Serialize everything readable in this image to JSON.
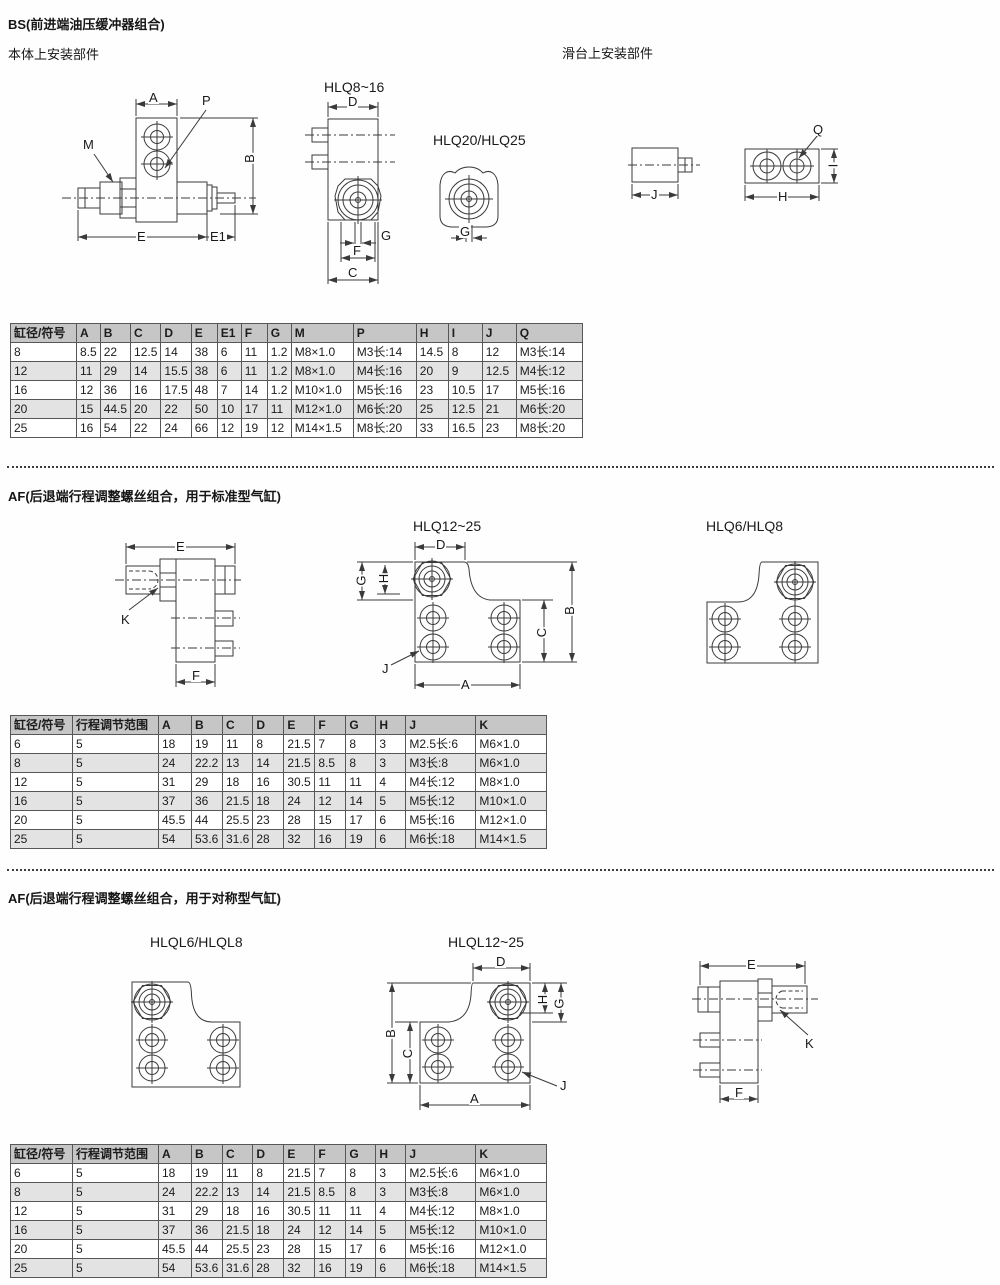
{
  "bs": {
    "title": "BS(前进端油压缓冲器组合)",
    "caption_left": "本体上安装部件",
    "caption_right": "滑台上安装部件",
    "fig_titles": {
      "hlq816": "HLQ8~16",
      "hlq2025": "HLQ20/HLQ25"
    },
    "dims": {
      "buffer": {
        "A": "A",
        "P": "P",
        "M": "M",
        "B": "B",
        "E": "E",
        "E1": "E1"
      },
      "hlq816": {
        "D": "D",
        "G": "G",
        "F": "F",
        "C": "C"
      },
      "hlq2025": {
        "G": "G"
      },
      "block": {
        "J": "J"
      },
      "plate": {
        "Q": "Q",
        "H": "H",
        "I": "I"
      }
    },
    "table": {
      "headers": [
        "缸径/符号",
        "A",
        "B",
        "C",
        "D",
        "E",
        "E1",
        "F",
        "G",
        "M",
        "P",
        "H",
        "I",
        "J",
        "Q"
      ],
      "rows": [
        [
          "8",
          "8.5",
          "22",
          "12.5",
          "14",
          "38",
          "6",
          "11",
          "1.2",
          "M8×1.0",
          "M3长:14",
          "14.5",
          "8",
          "12",
          "M3长:14"
        ],
        [
          "12",
          "11",
          "29",
          "14",
          "15.5",
          "38",
          "6",
          "11",
          "1.2",
          "M8×1.0",
          "M4长:16",
          "20",
          "9",
          "12.5",
          "M4长:12"
        ],
        [
          "16",
          "12",
          "36",
          "16",
          "17.5",
          "48",
          "7",
          "14",
          "1.2",
          "M10×1.0",
          "M5长:16",
          "23",
          "10.5",
          "17",
          "M5长:16"
        ],
        [
          "20",
          "15",
          "44.5",
          "20",
          "22",
          "50",
          "10",
          "17",
          "11",
          "M12×1.0",
          "M6长:20",
          "25",
          "12.5",
          "21",
          "M6长:20"
        ],
        [
          "25",
          "16",
          "54",
          "22",
          "24",
          "66",
          "12",
          "19",
          "12",
          "M14×1.5",
          "M8长:20",
          "33",
          "16.5",
          "23",
          "M8长:20"
        ]
      ]
    }
  },
  "af_std": {
    "title": "AF(后退端行程调整螺丝组合，用于标准型气缸)",
    "fig_titles": {
      "hlq1225": "HLQ12~25",
      "hlq68": "HLQ6/HLQ8"
    },
    "dims": {
      "side": {
        "E": "E",
        "K": "K",
        "F": "F"
      },
      "plate": {
        "D": "D",
        "G": "G",
        "H": "H",
        "B": "B",
        "C": "C",
        "A": "A",
        "J": "J"
      }
    },
    "table": {
      "headers": [
        "缸径/符号",
        "行程调节范围",
        "A",
        "B",
        "C",
        "D",
        "E",
        "F",
        "G",
        "H",
        "J",
        "K"
      ],
      "rows": [
        [
          "6",
          "5",
          "18",
          "19",
          "11",
          "8",
          "21.5",
          "7",
          "8",
          "3",
          "M2.5长:6",
          "M6×1.0"
        ],
        [
          "8",
          "5",
          "24",
          "22.2",
          "13",
          "14",
          "21.5",
          "8.5",
          "8",
          "3",
          "M3长:8",
          "M6×1.0"
        ],
        [
          "12",
          "5",
          "31",
          "29",
          "18",
          "16",
          "30.5",
          "11",
          "11",
          "4",
          "M4长:12",
          "M8×1.0"
        ],
        [
          "16",
          "5",
          "37",
          "36",
          "21.5",
          "18",
          "24",
          "12",
          "14",
          "5",
          "M5长:12",
          "M10×1.0"
        ],
        [
          "20",
          "5",
          "45.5",
          "44",
          "25.5",
          "23",
          "28",
          "15",
          "17",
          "6",
          "M5长:16",
          "M12×1.0"
        ],
        [
          "25",
          "5",
          "54",
          "53.6",
          "31.6",
          "28",
          "32",
          "16",
          "19",
          "6",
          "M6长:18",
          "M14×1.5"
        ]
      ]
    }
  },
  "af_sym": {
    "title": "AF(后退端行程调整螺丝组合，用于对称型气缸)",
    "fig_titles": {
      "hlql68": "HLQL6/HLQL8",
      "hlql1225": "HLQL12~25"
    },
    "dims": {
      "plate": {
        "D": "D",
        "H": "H",
        "G": "G",
        "B": "B",
        "C": "C",
        "A": "A",
        "J": "J"
      },
      "side": {
        "E": "E",
        "K": "K",
        "F": "F"
      }
    },
    "table": {
      "headers": [
        "缸径/符号",
        "行程调节范围",
        "A",
        "B",
        "C",
        "D",
        "E",
        "F",
        "G",
        "H",
        "J",
        "K"
      ],
      "rows": [
        [
          "6",
          "5",
          "18",
          "19",
          "11",
          "8",
          "21.5",
          "7",
          "8",
          "3",
          "M2.5长:6",
          "M6×1.0"
        ],
        [
          "8",
          "5",
          "24",
          "22.2",
          "13",
          "14",
          "21.5",
          "8.5",
          "8",
          "3",
          "M3长:8",
          "M6×1.0"
        ],
        [
          "12",
          "5",
          "31",
          "29",
          "18",
          "16",
          "30.5",
          "11",
          "11",
          "4",
          "M4长:12",
          "M8×1.0"
        ],
        [
          "16",
          "5",
          "37",
          "36",
          "21.5",
          "18",
          "24",
          "12",
          "14",
          "5",
          "M5长:12",
          "M10×1.0"
        ],
        [
          "20",
          "5",
          "45.5",
          "44",
          "25.5",
          "23",
          "28",
          "15",
          "17",
          "6",
          "M5长:16",
          "M12×1.0"
        ],
        [
          "25",
          "5",
          "54",
          "53.6",
          "31.6",
          "28",
          "32",
          "16",
          "19",
          "6",
          "M6长:18",
          "M14×1.5"
        ]
      ]
    }
  },
  "colors": {
    "table_header_bg": "#c6c6c6",
    "table_alt_row_bg": "#e3e3e3",
    "line": "#3a3a3a"
  }
}
